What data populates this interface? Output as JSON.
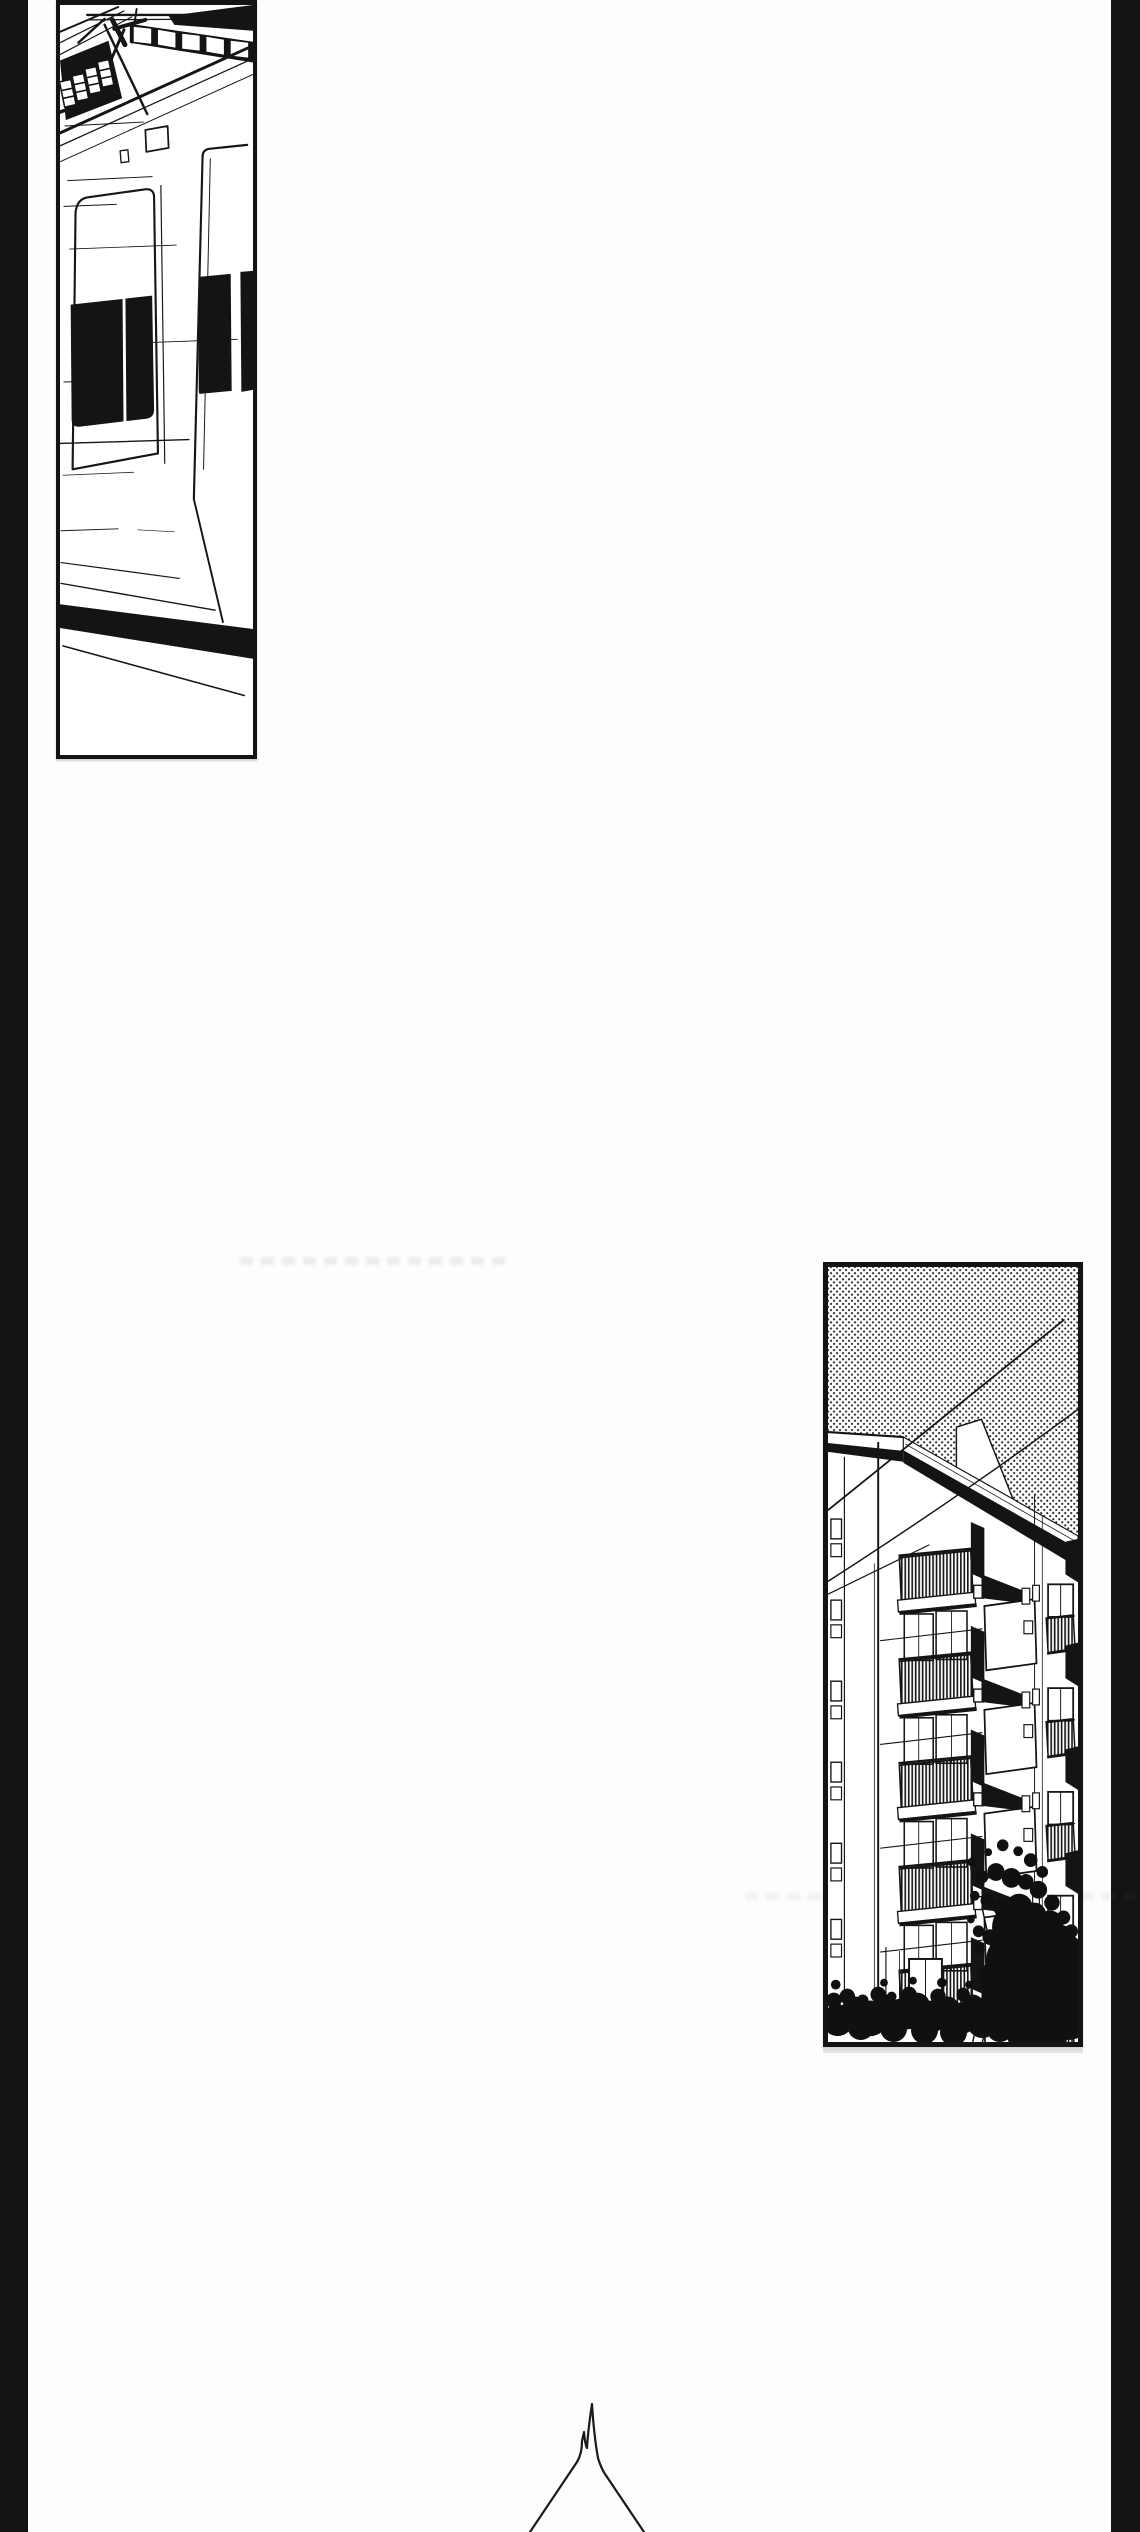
{
  "page": {
    "type": "manga page",
    "format": "vertical webtoon strip",
    "text_content": "none"
  },
  "colors": {
    "paper": "#fdfdfd",
    "ink": "#141414",
    "gutter": "#131313",
    "screentone_dot": "#1c1c1c"
  },
  "panels": [
    {
      "id": "train",
      "description": "Line-art panel: side of a commuter train at a station, overhead canopy beams and pantograph with white insulators on a black field above the roof line, two sliding doors with black windows, horizontal speed lines, heavy black stripe along the lower body."
    },
    {
      "id": "apartment",
      "description": "Line-art panel: low-angle view of an apartment block against a halftone-dot sky, thin power lines crossing diagonally, white eave band with heavy black shadow, rows of balconies with hatched railings, small windows, dark tree silhouette across the bottom."
    },
    {
      "id": "roof-peak",
      "description": "Thin line drawing of a narrow peak with a small forked spike rising from the bottom edge of the page."
    }
  ],
  "artifacts": [
    {
      "id": "faint-smudge-1",
      "description": "very faint illegible gray smudge line"
    },
    {
      "id": "faint-smudge-2",
      "description": "very faint gray smudge line in panel margins"
    },
    {
      "id": "faint-smudge-3",
      "description": "faint gray line under apartment panel"
    }
  ]
}
